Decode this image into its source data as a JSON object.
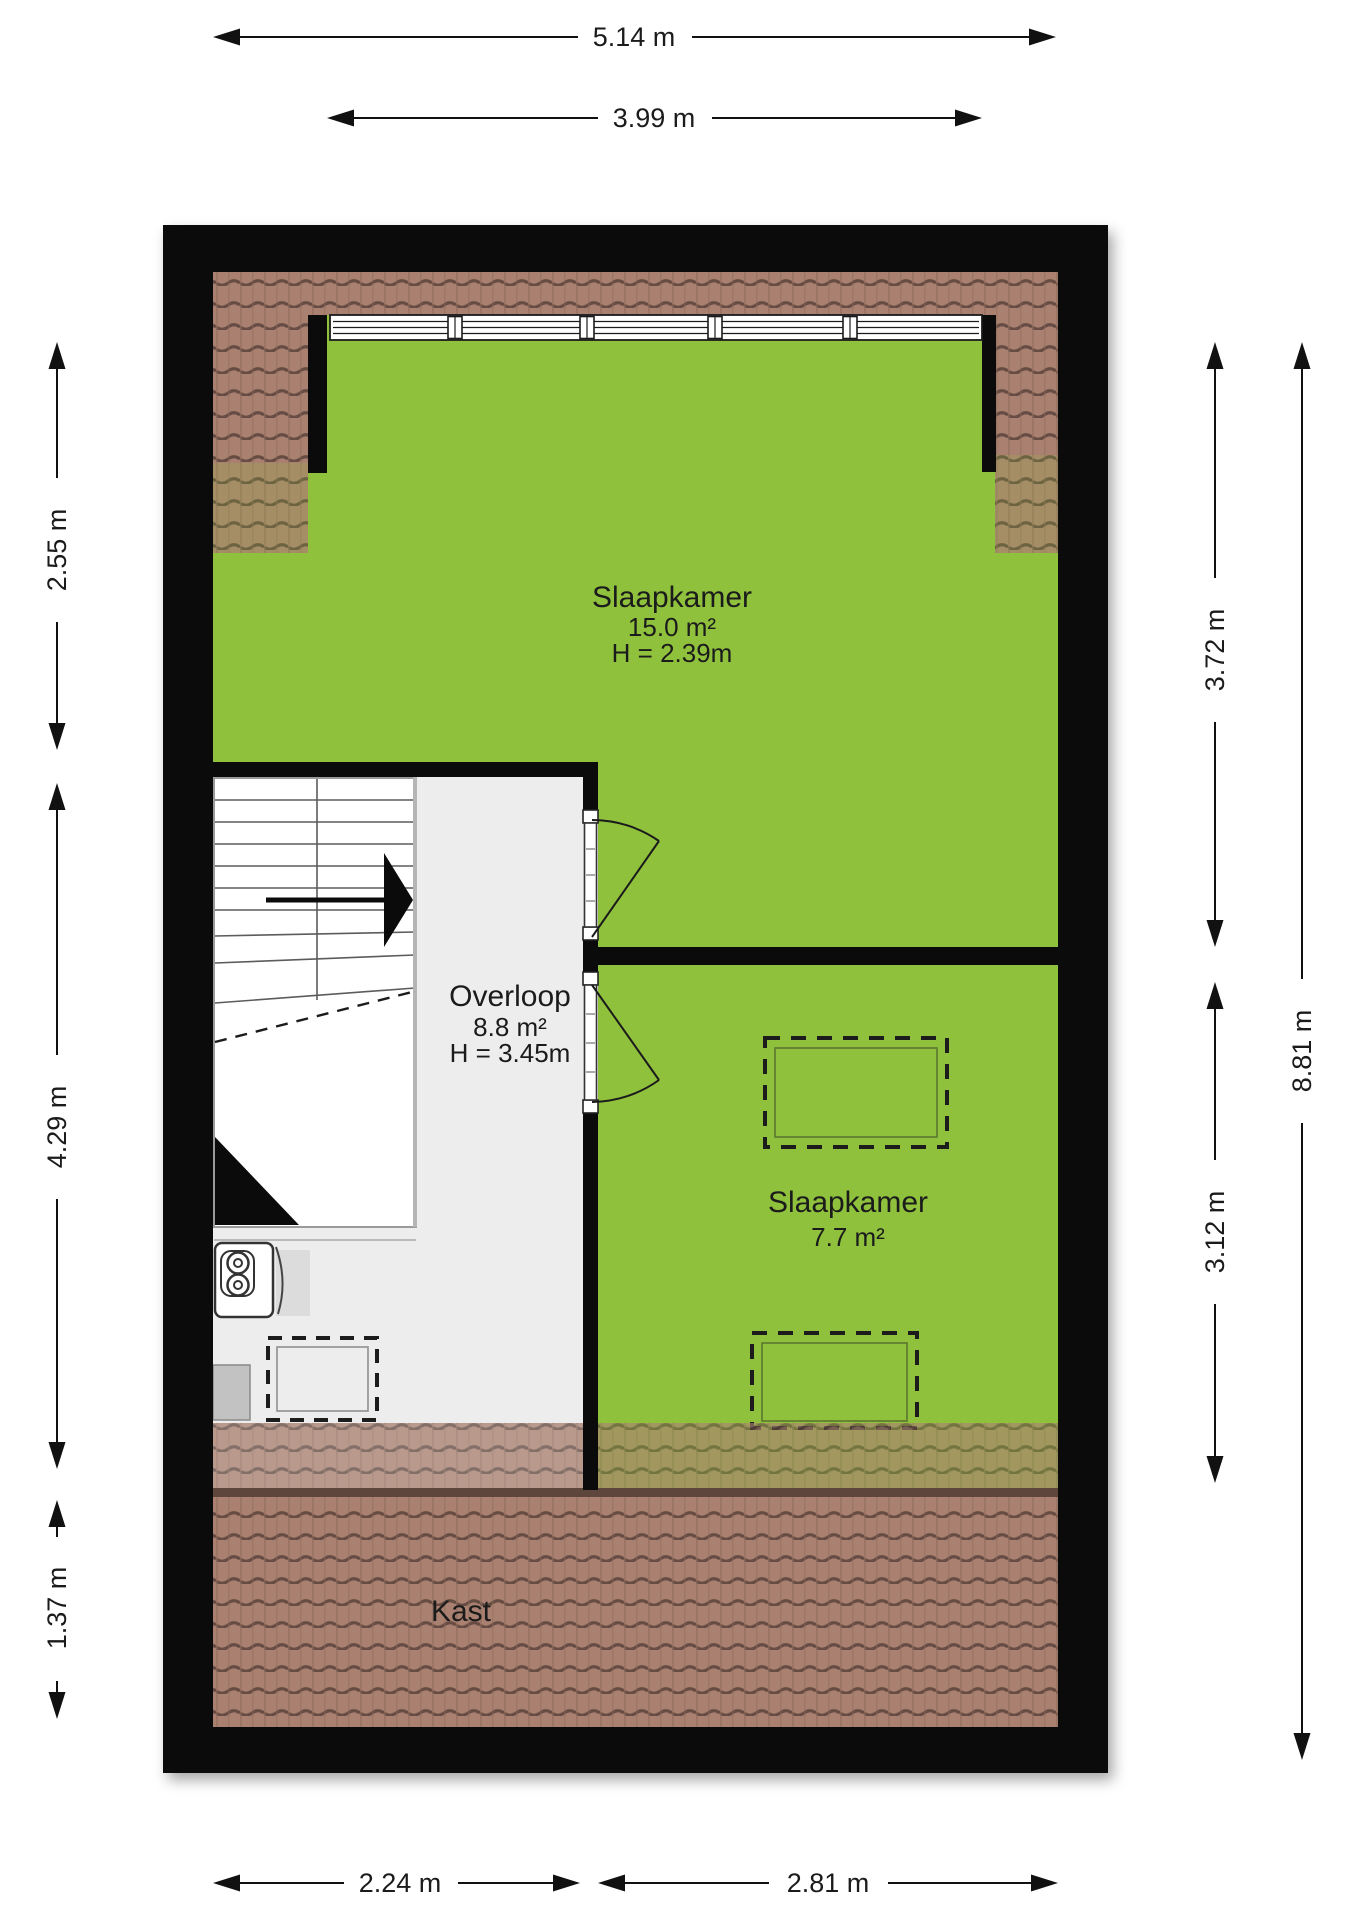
{
  "plan": {
    "rooms": {
      "bedroom_large": {
        "name": "Slaapkamer",
        "area": "15.0 m²",
        "height": "H = 2.39m"
      },
      "landing": {
        "name": "Overloop",
        "area": "8.8 m²",
        "height": "H = 3.45m"
      },
      "bedroom_small": {
        "name": "Slaapkamer",
        "area": "7.7 m²"
      },
      "closet": {
        "name": "Kast"
      }
    },
    "dimensions": {
      "top_outer_width": "5.14 m",
      "top_inner_width": "3.99 m",
      "left_top": "2.55 m",
      "left_middle": "4.29 m",
      "left_bottom": "1.37 m",
      "right_top": "3.72 m",
      "right_bottom": "3.12 m",
      "right_total_height": "8.81 m",
      "bottom_left_width": "2.24 m",
      "bottom_right_width": "2.81 m"
    },
    "colors": {
      "wall": "#0b0b0b",
      "floor_green": "#8fc13d",
      "floor_gray": "#ededed",
      "tile_base": "#aa8170",
      "tile_seam": "#5f463c"
    }
  }
}
